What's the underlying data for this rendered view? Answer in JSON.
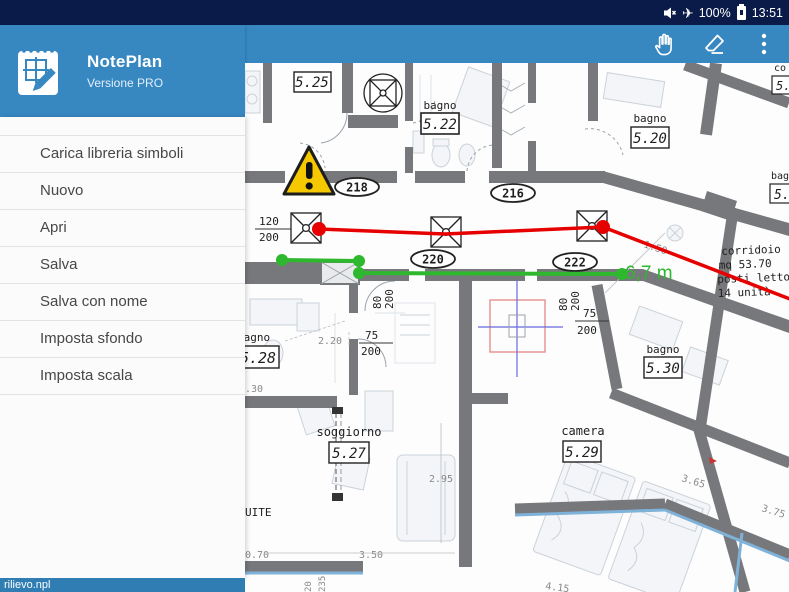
{
  "status_bar": {
    "battery_percent": "100%",
    "time": "13:51"
  },
  "app_header": {
    "title": "NotePlan",
    "subtitle": "Versione PRO"
  },
  "menu": {
    "items": [
      {
        "label": "Carica libreria simboli"
      },
      {
        "label": "Nuovo"
      },
      {
        "label": "Apri"
      },
      {
        "label": "Salva"
      },
      {
        "label": "Salva con nome"
      },
      {
        "label": "Imposta sfondo"
      },
      {
        "label": "Imposta scala"
      }
    ]
  },
  "file_bar": {
    "filename": "rilievo.npl"
  },
  "plan": {
    "measurement_label": "6,7 m",
    "door_numbers": [
      {
        "label": "218"
      },
      {
        "label": "216"
      },
      {
        "label": "220"
      },
      {
        "label": "222"
      }
    ],
    "rooms": [
      {
        "name": "",
        "number": "5.25"
      },
      {
        "name": "bagno",
        "number": "5.22"
      },
      {
        "name": "bagno",
        "number": "5.20"
      },
      {
        "name": "bagno",
        "number": "5.28"
      },
      {
        "name": "soggiorno",
        "number": "5.27"
      },
      {
        "name": "camera",
        "number": "5.29"
      },
      {
        "name": "bagno",
        "number": "5.30"
      }
    ],
    "corridor_note": {
      "line1": "corridoio",
      "line2": "mq  53.70",
      "line3": "posti letto",
      "line4": "14 unità"
    },
    "edge_labels": {
      "top_name": "co",
      "top_number": "5.",
      "mid_name": "bag",
      "mid_number": "5."
    },
    "dimensions": {
      "frac1_top": "120",
      "frac1_bot": "200",
      "frac2_top": "75",
      "frac2_bot": "200",
      "frac3_top": "75",
      "frac3_bot": "200",
      "v1a": "80",
      "v1b": "200",
      "v2a": "80",
      "v2b": "200",
      "d_220": "2.20",
      "d_130": ".30",
      "d_295": "2.95",
      "d_350": "3.50",
      "d_070": "0.70",
      "d_150": "1.50",
      "d_365": "3.65",
      "d_375": "3.75",
      "d_415": "4.15",
      "suite": "UITE",
      "v3a": "20",
      "v3b": "235"
    }
  },
  "colors": {
    "header_blue": "#3787c1",
    "status_navy": "#0a1b4a",
    "annotation_red": "#e60000",
    "annotation_green": "#2eb82e",
    "warning_yellow": "#f6c800",
    "wall_gray": "#77787b"
  }
}
